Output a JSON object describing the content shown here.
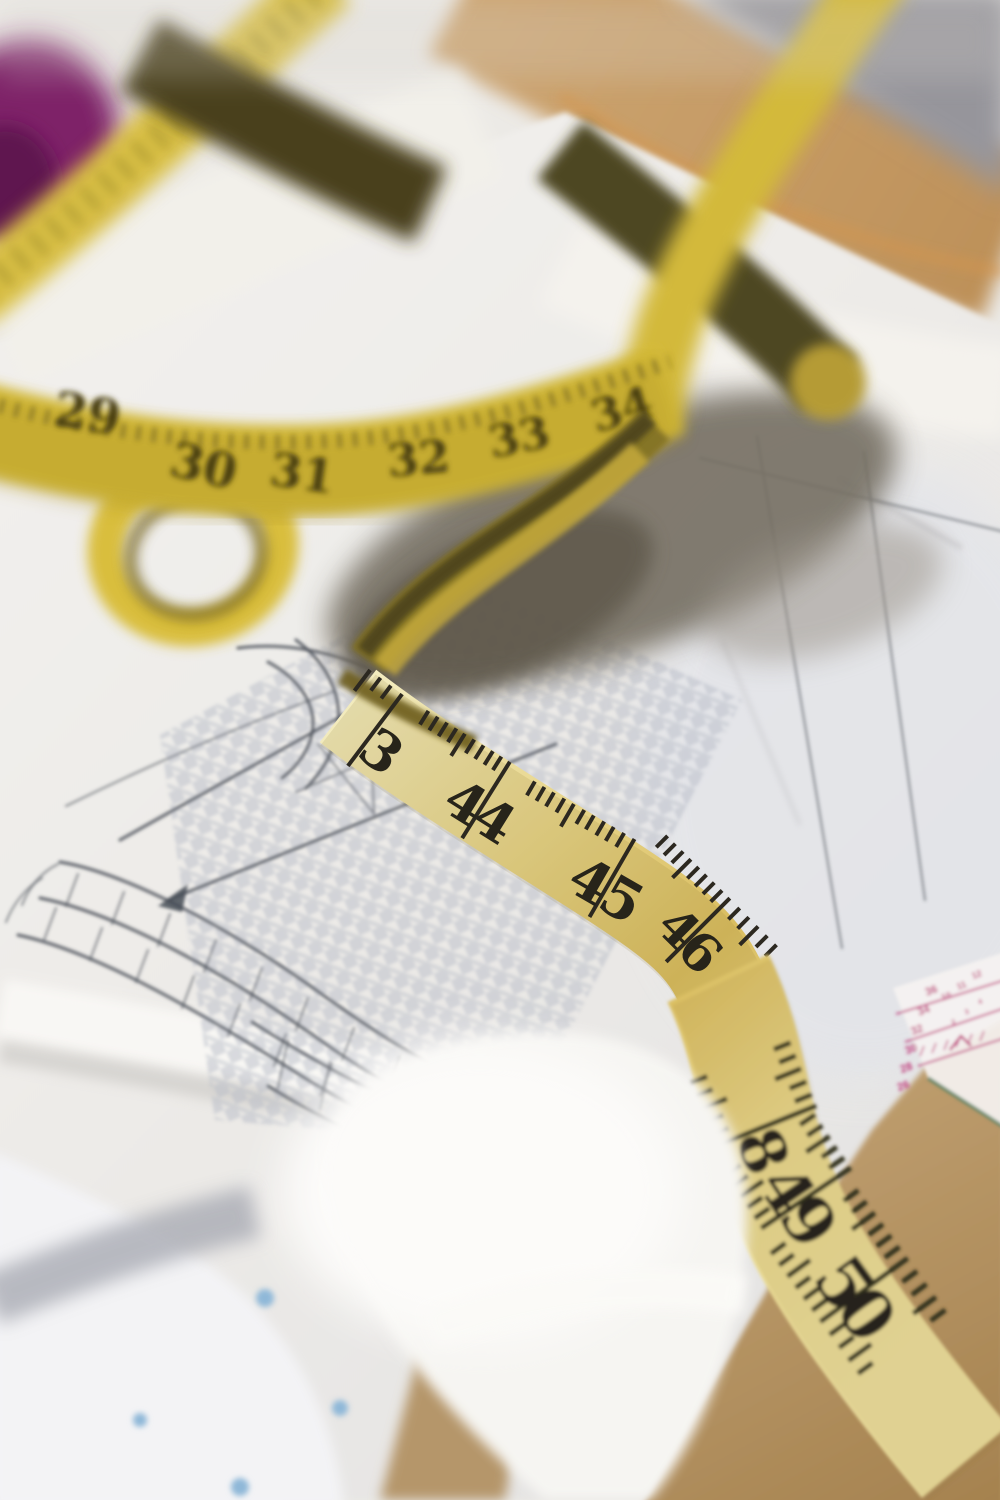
{
  "tape": {
    "upper_numbers": [
      "29",
      "30",
      "31",
      "32",
      "33",
      "34"
    ],
    "main_marks": [
      {
        "left": "",
        "right": "3"
      },
      {
        "left": "4",
        "right": "4"
      },
      {
        "left": "4",
        "right": "5"
      },
      {
        "left": "4",
        "right": "6"
      }
    ],
    "lower_marks": [
      {
        "left": "",
        "right": "8"
      },
      {
        "left": "4",
        "right": "9"
      },
      {
        "left": "5",
        "right": "0"
      }
    ],
    "body_color": "#e2cd7a",
    "shadow_side_color": "#4e4722",
    "ink_color": "#27241a"
  },
  "ruler": {
    "column_numbers": [
      "36",
      "34",
      "32",
      "30",
      "28",
      "26"
    ],
    "row_numbers": [
      "10",
      "11",
      "12"
    ],
    "row2_numbers": [
      "2",
      "3",
      "4"
    ],
    "mark_color": "#bf3d7c"
  },
  "palette": {
    "paper_white": "#efede9",
    "kraft_brown": "#b3915f",
    "wood_tan": "#c69e66",
    "wall_gray": "#96959b",
    "houndstooth_gray": "#b7bdc7",
    "sketch_ink": "#474c56",
    "fabric_dot_blue": "#8fb8d8",
    "purple_object": "#7e2068"
  }
}
